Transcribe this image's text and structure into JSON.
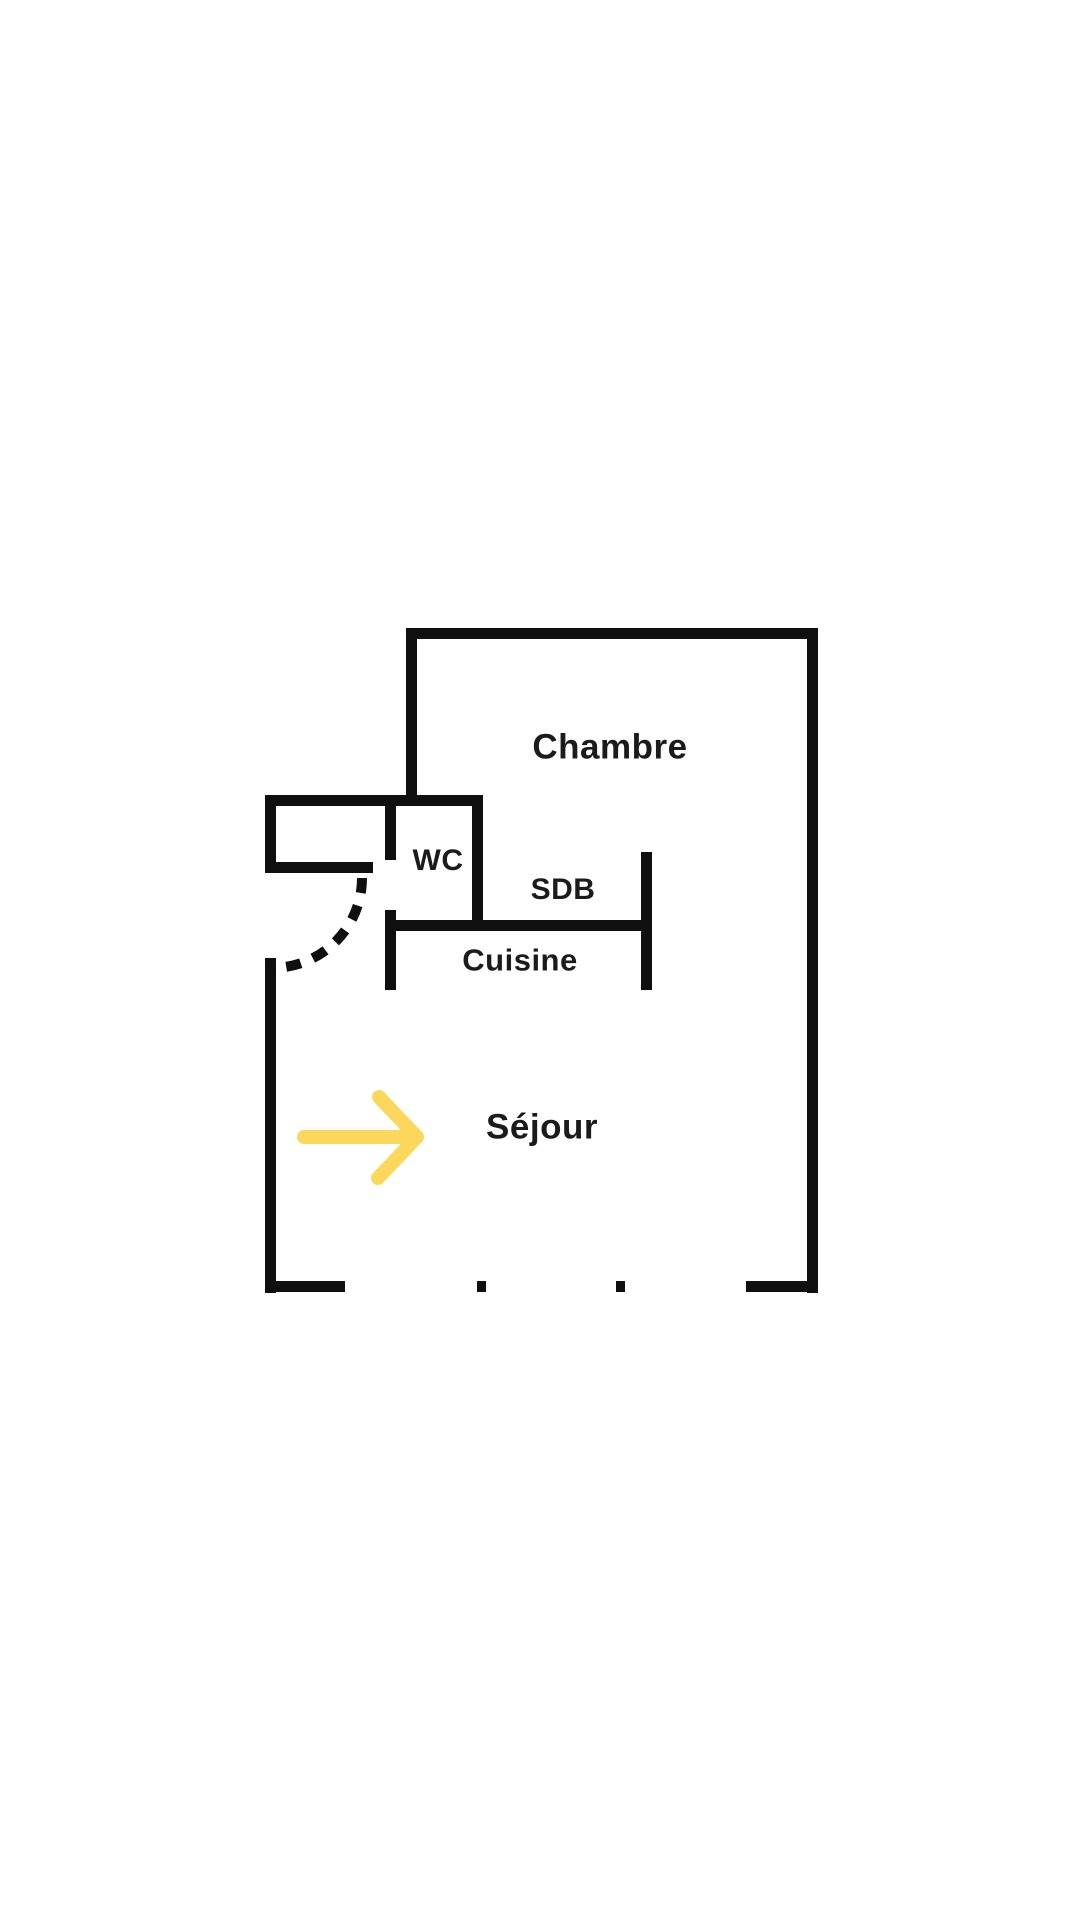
{
  "page": {
    "background": "#ffffff"
  },
  "floor_plan": {
    "wall_color": "#0f0f0f",
    "text_color": "#1b1b1b",
    "accent_color": "#FBD85C",
    "canvas": {
      "width": 1080,
      "height": 1920
    },
    "labels": {
      "chambre": {
        "text": "Chambre",
        "x": 610,
        "y": 747,
        "size": 35
      },
      "wc": {
        "text": "WC",
        "x": 438,
        "y": 861,
        "size": 30
      },
      "sdb": {
        "text": "SDB",
        "x": 563,
        "y": 890,
        "size": 30
      },
      "cuisine": {
        "text": "Cuisine",
        "x": 520,
        "y": 960,
        "size": 31
      },
      "sejour": {
        "text": "Séjour",
        "x": 542,
        "y": 1127,
        "size": 35
      }
    },
    "walls": [
      {
        "name": "top-wall",
        "x": 406,
        "y": 628,
        "w": 412,
        "h": 11
      },
      {
        "name": "right-wall",
        "x": 807,
        "y": 628,
        "w": 11,
        "h": 665
      },
      {
        "name": "chambre-left-wall",
        "x": 406,
        "y": 628,
        "w": 11,
        "h": 178
      },
      {
        "name": "entry-top-wall",
        "x": 265,
        "y": 795,
        "w": 218,
        "h": 11
      },
      {
        "name": "entry-left-wall",
        "x": 265,
        "y": 795,
        "w": 11,
        "h": 78
      },
      {
        "name": "entry-bottom-wall",
        "x": 265,
        "y": 862,
        "w": 108,
        "h": 11
      },
      {
        "name": "wc-left-wall-upper",
        "x": 385,
        "y": 806,
        "w": 11,
        "h": 54
      },
      {
        "name": "wc-left-wall-lower",
        "x": 385,
        "y": 910,
        "w": 11,
        "h": 80
      },
      {
        "name": "wc-right-wall",
        "x": 472,
        "y": 795,
        "w": 11,
        "h": 136
      },
      {
        "name": "kitchen-top-wall",
        "x": 385,
        "y": 920,
        "w": 256,
        "h": 11
      },
      {
        "name": "sdb-right-wall",
        "x": 641,
        "y": 852,
        "w": 11,
        "h": 138
      },
      {
        "name": "sejour-left-wall",
        "x": 265,
        "y": 958,
        "w": 11,
        "h": 335
      },
      {
        "name": "bottom-wall-left",
        "x": 265,
        "y": 1281,
        "w": 80,
        "h": 11
      },
      {
        "name": "bottom-window-tick-1",
        "x": 477,
        "y": 1281,
        "w": 9,
        "h": 11
      },
      {
        "name": "bottom-window-tick-2",
        "x": 616,
        "y": 1281,
        "w": 9,
        "h": 11
      },
      {
        "name": "bottom-wall-right",
        "x": 746,
        "y": 1281,
        "w": 72,
        "h": 11
      }
    ],
    "door_arc": {
      "cx": 272,
      "cy": 878,
      "r": 90,
      "stroke_width": 10,
      "dash": "15 13"
    },
    "arrow": {
      "shaft": {
        "x1": 304,
        "y1": 1137,
        "x2": 408,
        "y2": 1137
      },
      "head": [
        [
          379,
          1097
        ],
        [
          417,
          1137
        ],
        [
          378,
          1178
        ]
      ],
      "stroke_width": 14
    }
  }
}
